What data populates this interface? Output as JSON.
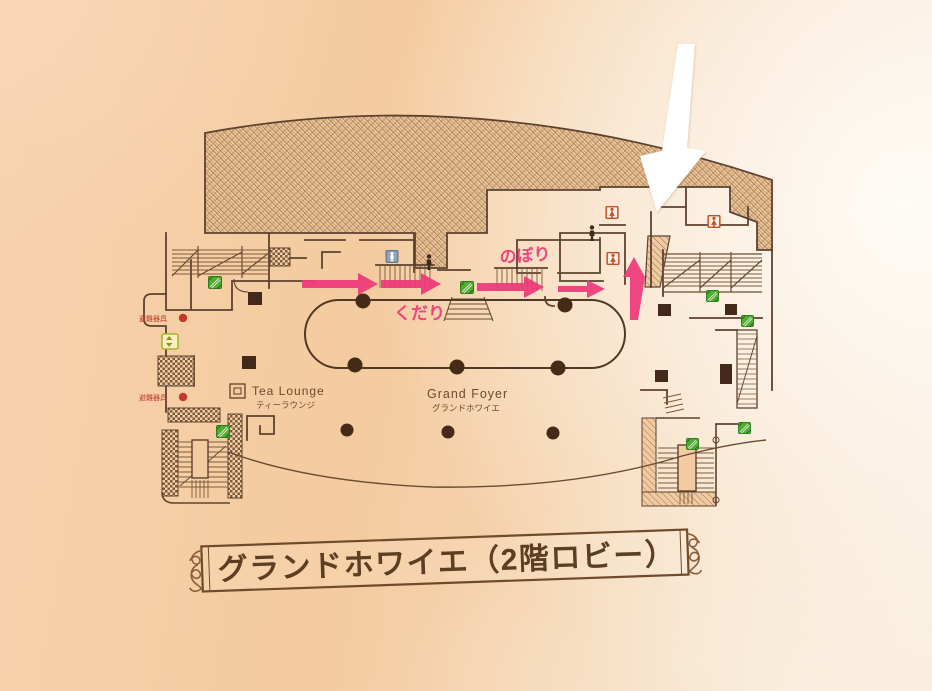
{
  "banner": {
    "title": "グランドホワイエ（2階ロビー）"
  },
  "map": {
    "rooms": {
      "tea_lounge": {
        "en": "Tea Lounge",
        "jp": "ティーラウンジ"
      },
      "grand_foyer": {
        "en": "Grand Foyer",
        "jp": "グランドホワイエ"
      }
    },
    "route": {
      "up_label": "のぼり",
      "down_label": "くだり",
      "arrow_directions": [
        "right",
        "right",
        "right",
        "right",
        "up"
      ],
      "arrow_color": "#ee3a7b",
      "highlight_arrow_color": "#ffffff"
    },
    "evacuation": [
      "避難器具",
      "避難器具"
    ],
    "icon_counts": {
      "escalator": 7,
      "restroom_women": 3,
      "restroom_men": 1,
      "elevator": 1,
      "evacuation_equipment": 2
    },
    "colors": {
      "wall_line": "#5e4230",
      "stair_line": "#7b5a3b",
      "pillar": "#43291a",
      "escalator_green": "#4fae2f",
      "restroom_red": "#c2502a",
      "restroom_blue": "#91a3b5",
      "elevator_yellow_green": "#a9b42a",
      "evac_red": "#c0392b",
      "paper_peach": "#f4cda6"
    }
  }
}
